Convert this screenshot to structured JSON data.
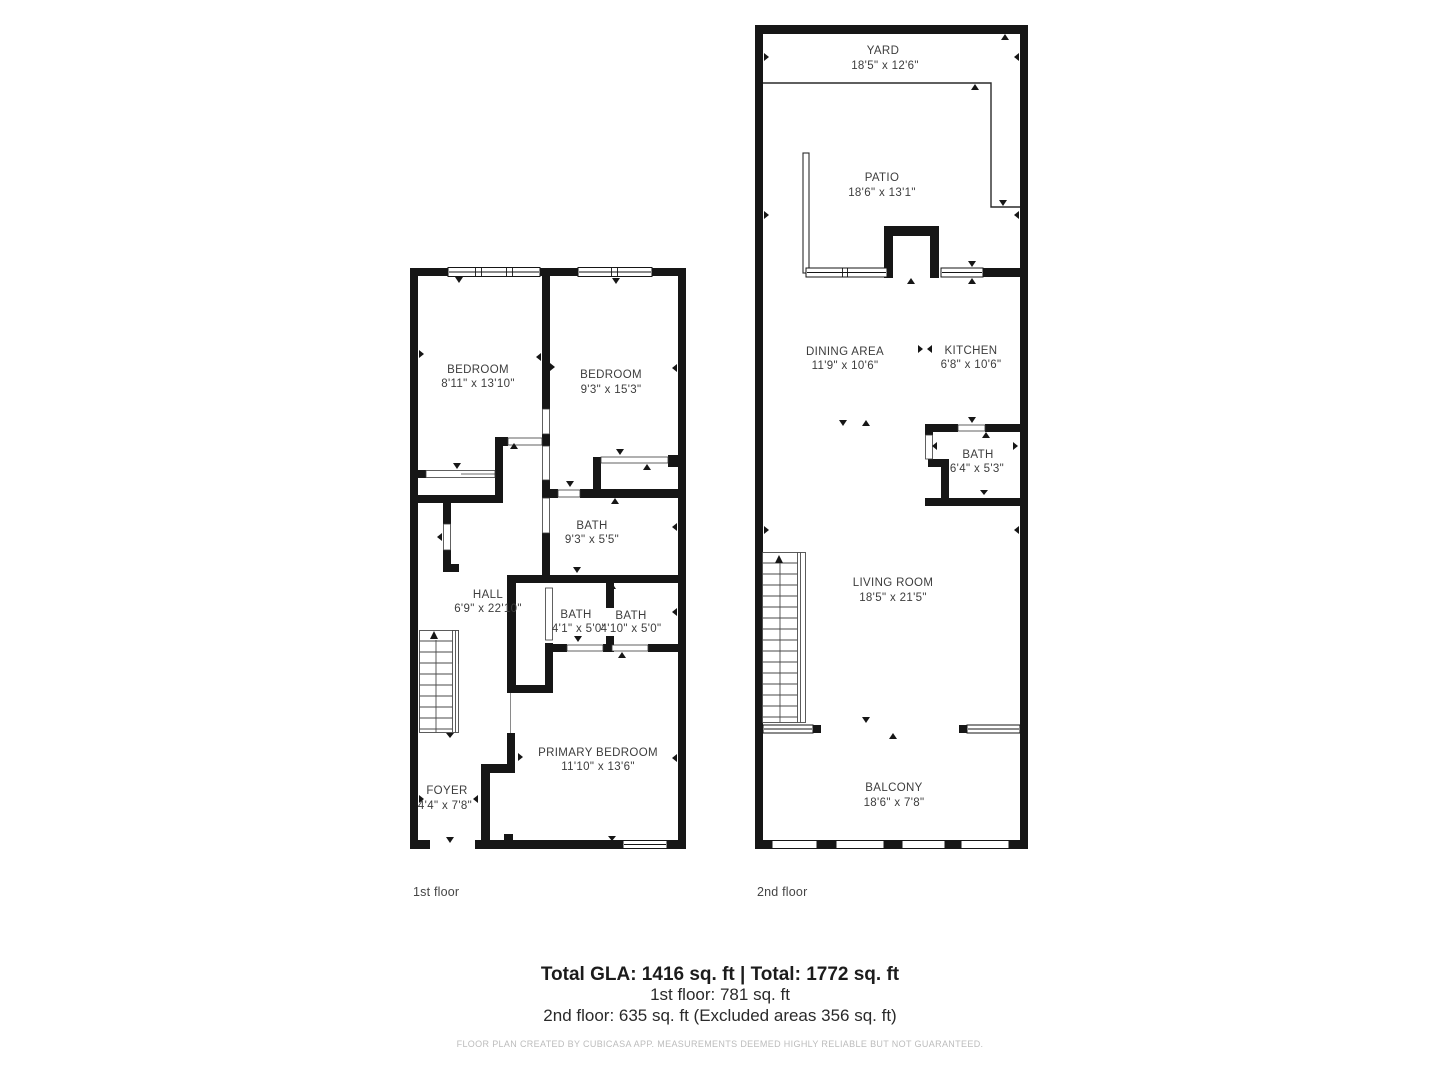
{
  "floor1": {
    "label": "1st floor",
    "rooms": {
      "bedroom_left": {
        "name": "BEDROOM",
        "dims": "8'11\" x 13'10\""
      },
      "bedroom_right": {
        "name": "BEDROOM",
        "dims": "9'3\" x 15'3\""
      },
      "bath_main": {
        "name": "BATH",
        "dims": "9'3\" x 5'5\""
      },
      "hall": {
        "name": "HALL",
        "dims": "6'9\" x 22'10\""
      },
      "bath_left": {
        "name": "BATH",
        "dims": "4'1\" x 5'0\""
      },
      "bath_right": {
        "name": "BATH",
        "dims": "4'10\" x 5'0\""
      },
      "primary_bedroom": {
        "name": "PRIMARY BEDROOM",
        "dims": "11'10\" x 13'6\""
      },
      "foyer": {
        "name": "FOYER",
        "dims": "4'4\" x 7'8\""
      }
    }
  },
  "floor2": {
    "label": "2nd floor",
    "rooms": {
      "yard": {
        "name": "YARD",
        "dims": "18'5\" x 12'6\""
      },
      "patio": {
        "name": "PATIO",
        "dims": "18'6\" x 13'1\""
      },
      "dining": {
        "name": "DINING AREA",
        "dims": "11'9\" x 10'6\""
      },
      "kitchen": {
        "name": "KITCHEN",
        "dims": "6'8\" x 10'6\""
      },
      "bath": {
        "name": "BATH",
        "dims": "6'4\" x 5'3\""
      },
      "living": {
        "name": "LIVING ROOM",
        "dims": "18'5\" x 21'5\""
      },
      "balcony": {
        "name": "BALCONY",
        "dims": "18'6\" x 7'8\""
      }
    }
  },
  "summary": {
    "total": "Total GLA: 1416 sq. ft | Total: 1772 sq. ft",
    "first_floor": "1st floor: 781 sq. ft",
    "second_floor": "2nd floor: 635 sq. ft (Excluded areas 356 sq. ft)",
    "disclaimer": "FLOOR PLAN CREATED BY CUBICASA APP. MEASUREMENTS DEEMED HIGHLY RELIABLE BUT NOT GUARANTEED."
  },
  "colors": {
    "wall": "#161616",
    "text": "#3d3d3d",
    "muted": "#bcbcbc"
  }
}
